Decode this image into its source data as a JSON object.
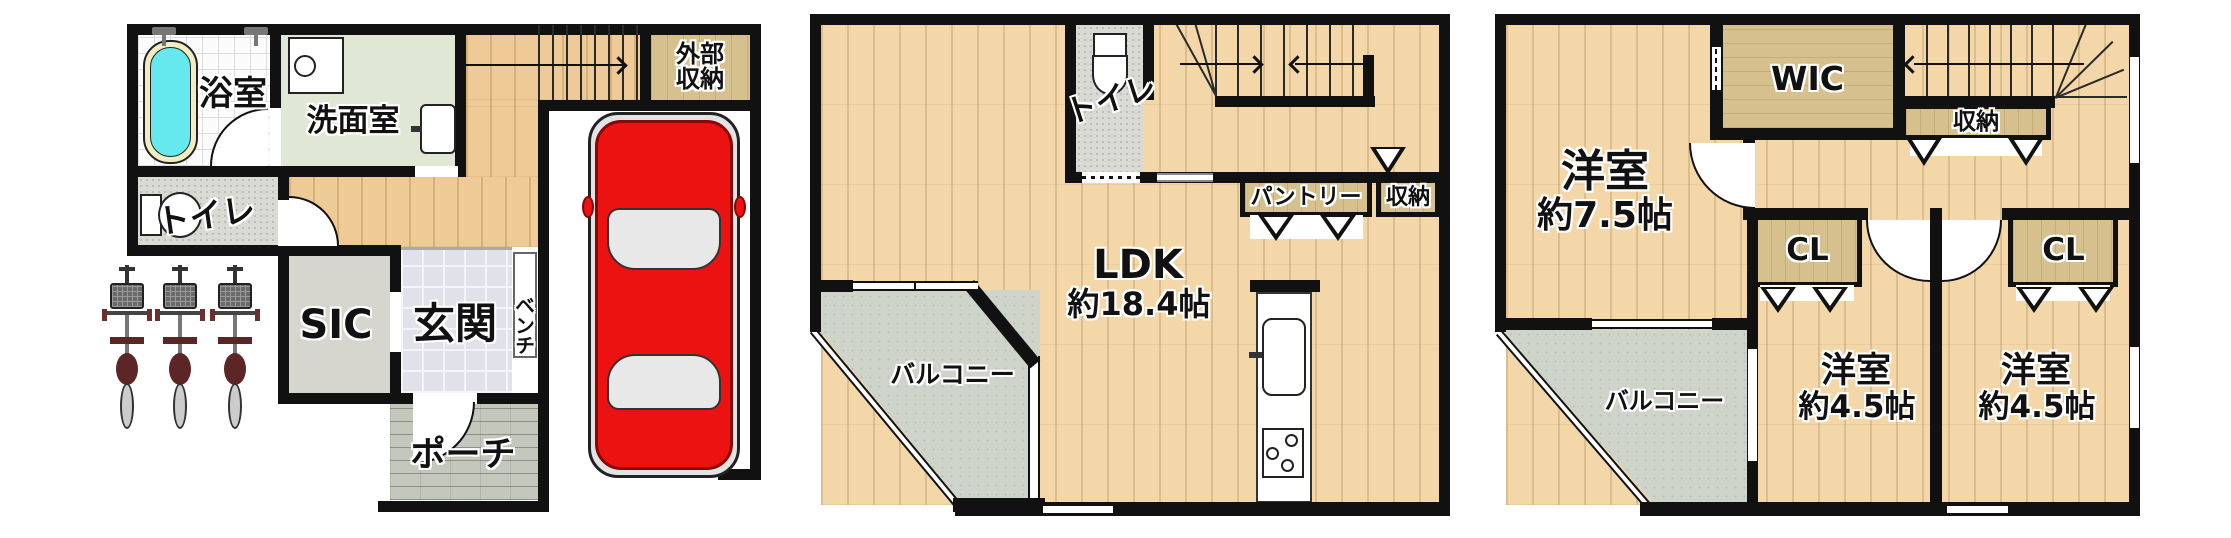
{
  "plan": {
    "floor1": {
      "bathroom": "浴室",
      "washroom": "洗面室",
      "toilet": "トイレ",
      "shoe_closet": "SIC",
      "entrance": "玄関",
      "bench": "ベンチ",
      "porch": "ポーチ",
      "external_storage": "外部収納"
    },
    "floor2": {
      "toilet": "トイレ",
      "ldk": "LDK",
      "ldk_size": "約18.4帖",
      "pantry": "パントリー",
      "storage": "収納",
      "balcony": "バルコニー"
    },
    "floor3": {
      "bedroom_main": "洋室",
      "bedroom_main_size": "約7.5帖",
      "wic": "WIC",
      "storage": "収納",
      "closet_left": "CL",
      "closet_right": "CL",
      "bedroom_left": "洋室",
      "bedroom_left_size": "約4.5帖",
      "bedroom_right": "洋室",
      "bedroom_right_size": "約4.5帖",
      "balcony": "バルコニー"
    },
    "colors": {
      "wall": "#111111",
      "wood_floor": "#eecb96",
      "wood_floor_light": "#f3d7a9",
      "closet_tan": "#d6c18e",
      "washroom_green": "#e0e7d5",
      "speckle_gray": "#dadad4",
      "entrance_marble": "#e0e1e9",
      "porch_gray": "#c3c7bc",
      "balcony_gray": "#cfd4ca",
      "bathtub_cyan": "#66e8ef",
      "car_red": "#ec1212"
    },
    "icons": [
      "bathtub-icon",
      "faucet-icon",
      "washing-machine-icon",
      "sink-icon",
      "toilet-icon",
      "bicycle-icon",
      "car-icon",
      "kitchen-sink-icon",
      "stove-icon",
      "stair-arrow",
      "door-swing-arc",
      "window",
      "door-opening-mark"
    ]
  }
}
